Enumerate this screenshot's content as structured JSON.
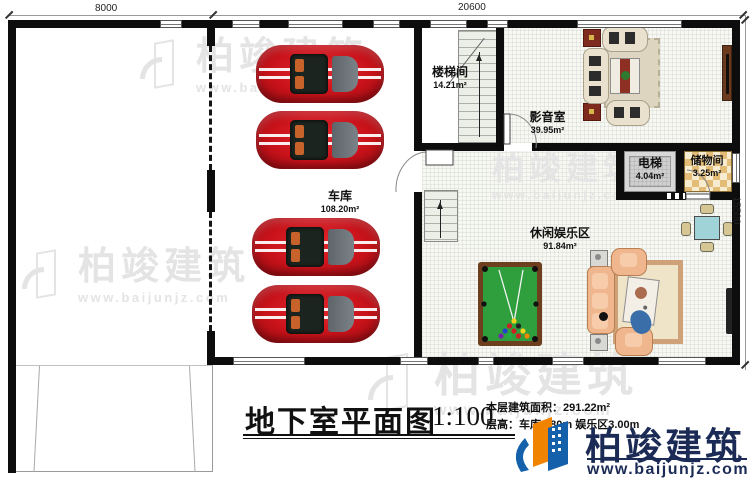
{
  "plan": {
    "drawing_type": "basement floor plan",
    "dimensions": {
      "top_left": "8000",
      "top_right": "20600",
      "right": "15500"
    },
    "rooms": [
      {
        "id": "garage",
        "name": "车库",
        "area": "108.20m²"
      },
      {
        "id": "stairwell",
        "name": "楼梯间",
        "area": "14.21m²"
      },
      {
        "id": "media",
        "name": "影音室",
        "area": "39.95m²"
      },
      {
        "id": "elevator",
        "name": "电梯",
        "area": "4.04m²"
      },
      {
        "id": "storage",
        "name": "储物间",
        "area": "3.25m²"
      },
      {
        "id": "leisure",
        "name": "休闲娱乐区",
        "area": "91.84m²"
      }
    ],
    "title_block": {
      "title": "地下室平面图",
      "scale": "1:100",
      "area_line": "本层建筑面积：291.22m²",
      "height_line": "层高：车库2.80m 娱乐区3.00m"
    }
  },
  "watermark": {
    "name": "柏竣建筑",
    "url": "www.baijunjz.com"
  },
  "logo": {
    "name": "柏竣建筑",
    "url": "www.baijunjz.com"
  },
  "colors": {
    "wall": "#0d0d0d",
    "car_red": "#c8121a",
    "billiard_green": "#2f9e3c",
    "logo_blue": "#1460aa",
    "logo_orange": "#f08300",
    "logo_navy": "#1b2b55",
    "watermark_gray": "#e4e4e4"
  }
}
